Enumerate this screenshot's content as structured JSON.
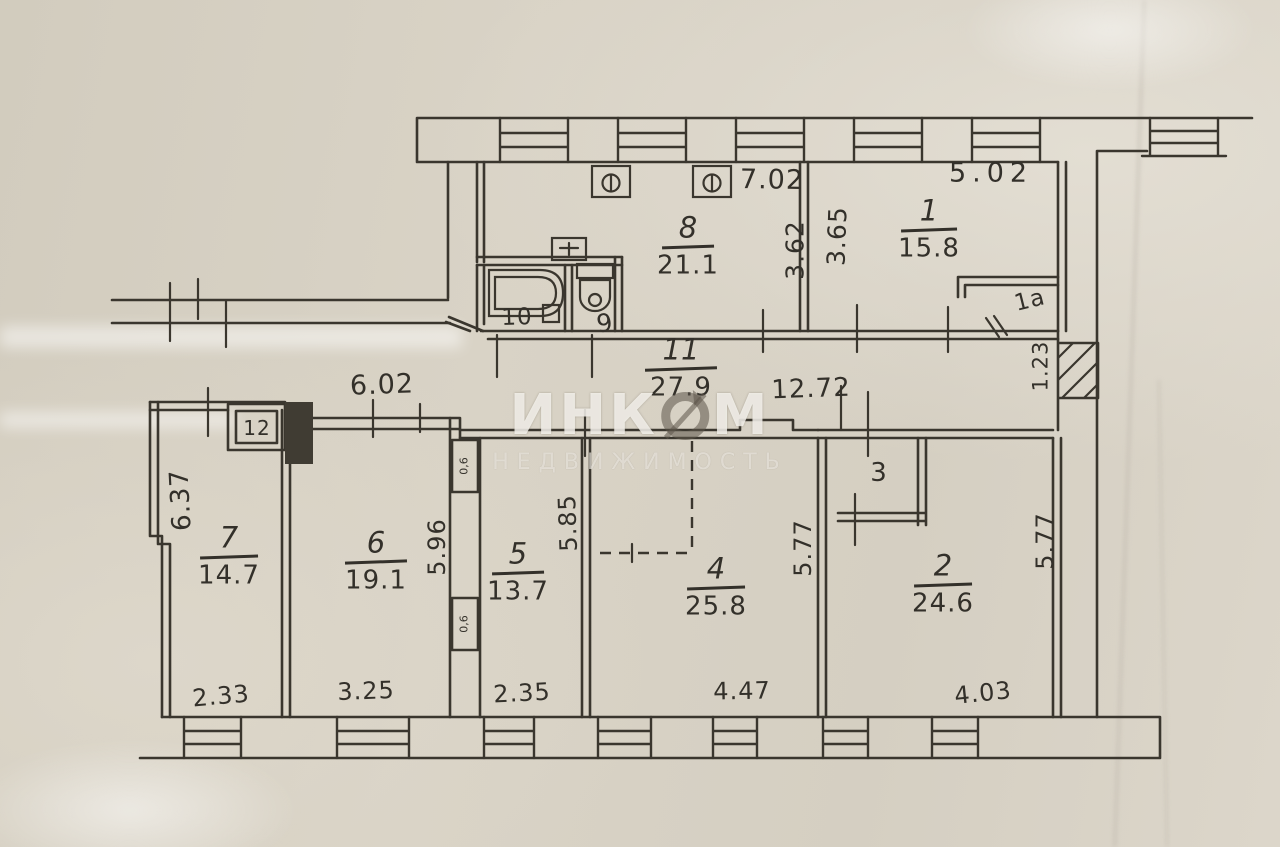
{
  "watermark": {
    "line1_pre": "ИНК",
    "line1_post": "М",
    "line2": "НЕДВИЖИМОСТЬ"
  },
  "rooms": {
    "r1": {
      "number": "1",
      "area": "15.8"
    },
    "r1a": {
      "number": "1а"
    },
    "r2": {
      "number": "2",
      "area": "24.6"
    },
    "r3": {
      "number": "3"
    },
    "r4": {
      "number": "4",
      "area": "25.8"
    },
    "r5": {
      "number": "5",
      "area": "13.7"
    },
    "r6": {
      "number": "6",
      "area": "19.1"
    },
    "r7": {
      "number": "7",
      "area": "14.7"
    },
    "r8": {
      "number": "8",
      "area": "21.1"
    },
    "r9": {
      "number": "9"
    },
    "r10": {
      "number": "10"
    },
    "r11": {
      "number": "11",
      "area": "27.9"
    },
    "r12": {
      "number": "12"
    }
  },
  "dimensions": {
    "top_kitchen": "7.02",
    "top_room1": "5.02",
    "kitchen_depth": "3.62",
    "room1_depth": "3.65",
    "hall_left": "6.02",
    "hall_right": "12.72",
    "shaft": "1.23",
    "room7_left": "6.37",
    "room6_right": "5.96",
    "room5_right": "5.85",
    "room4_right": "5.77",
    "room2_right": "5.77",
    "room7_width": "2.33",
    "room6_width": "3.25",
    "room5_width": "2.35",
    "room4_width": "4.47",
    "room2_width": "4.03",
    "closet_upper": "0,6",
    "closet_lower": "0,6"
  }
}
